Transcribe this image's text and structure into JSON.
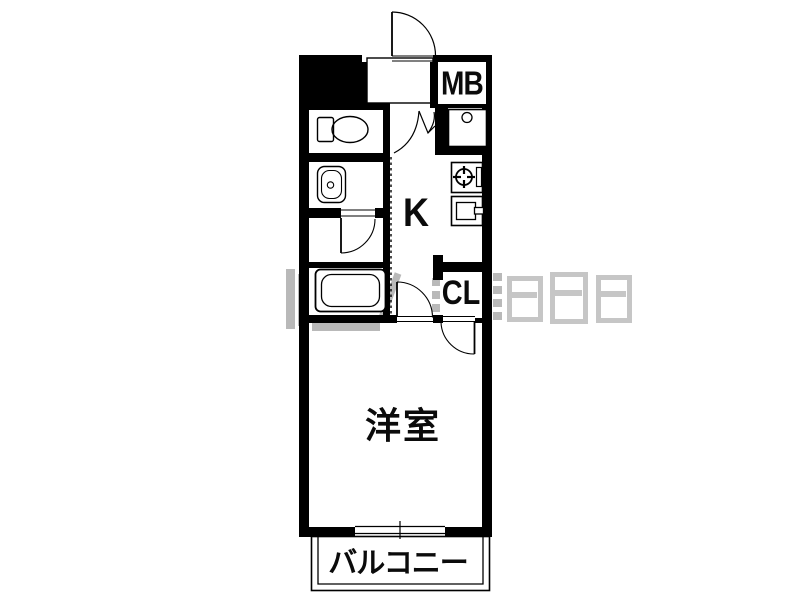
{
  "floor_plan": {
    "rooms": {
      "meter_box_label": "MB",
      "kitchen_label": "K",
      "closet_label": "CL",
      "western_room_label": "洋室",
      "balcony_label": "バルコニー"
    },
    "fixtures": [
      "entrance-door",
      "folding-door",
      "toilet",
      "washbasin",
      "bath-door",
      "bathtub",
      "utility-sink",
      "gas-stove",
      "kitchen-sink",
      "kitchen-door",
      "closet-door",
      "sliding-window"
    ],
    "colors": {
      "wall": "#000000",
      "floor": "#ffffff",
      "watermark": "#b9b9b9",
      "label_text": "#0b0b0b"
    }
  }
}
